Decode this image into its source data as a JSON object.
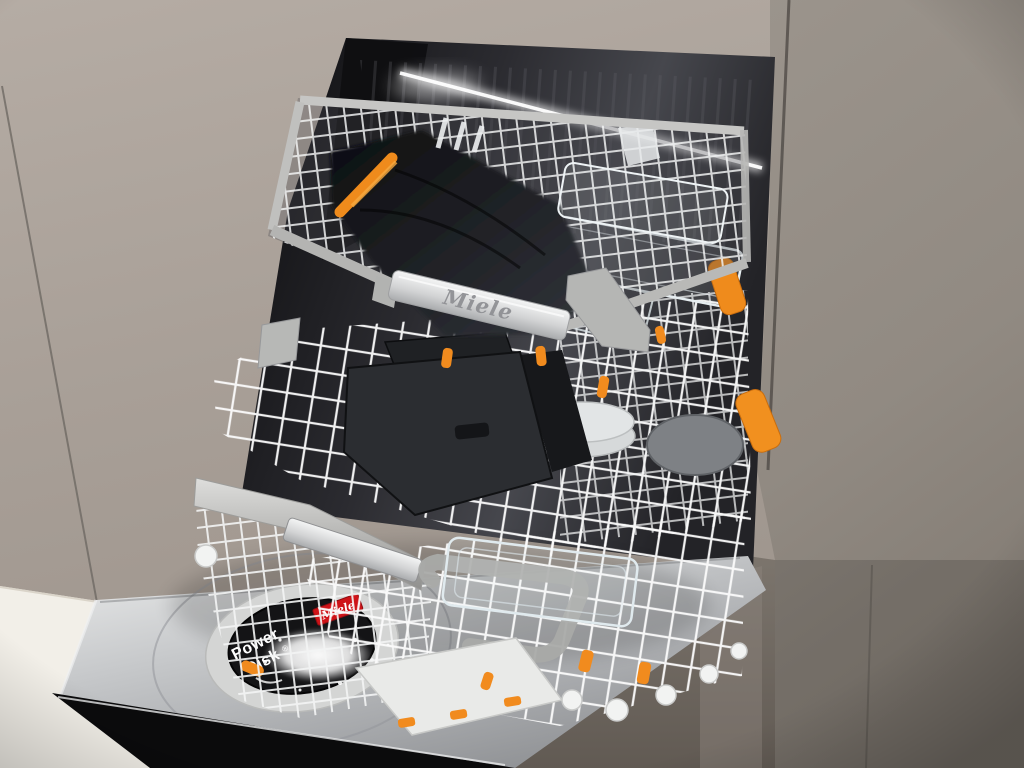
{
  "image": {
    "type": "photograph",
    "subject": "Miele dishwasher with three open loaded racks built into taupe kitchen cabinetry",
    "visible_objects": [
      "3D cutlery tray (top level) with black cloth item and glassware",
      "upper basket with black baking trays, plates and glass dishes",
      "lower basket with glass dish, small white tray and wheels",
      "PowerDisk detergent disc with white powder on open stainless door",
      "orange AutoOpen clips and holders",
      "white wire racks",
      "taupe cabinet panels and white countertop"
    ]
  },
  "labels": {
    "handle_brand": "Miele",
    "powerdisk_line1": "Power",
    "powerdisk_line2": "Disk",
    "powerdisk_reg": "®",
    "badge_brand": "Miele"
  },
  "colors": {
    "cabinet_left": "#a89f97",
    "cabinet_top": "#b2a9a1",
    "cabinet_right": "#968f88",
    "cabinet_lower": "#6e6760",
    "interior_dark": "#18181b",
    "rack_wire": "#f7f7f7",
    "rail_silver": "#c9c9c7",
    "accent_orange": "#f18b1e",
    "badge_red": "#ce1318",
    "door_steel": "#b9bbbd",
    "counter_white": "#f2efe8",
    "plinth_black": "#0c0c0d",
    "powerdisk_black": "#141416",
    "led_light": "#ffffff"
  }
}
